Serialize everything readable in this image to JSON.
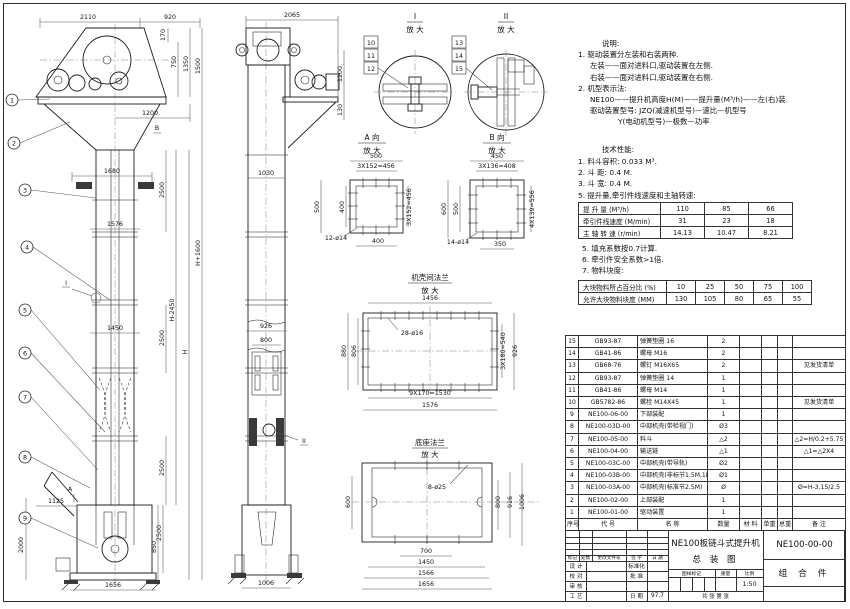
{
  "front": {
    "balloons": [
      "1",
      "2",
      "3",
      "4",
      "5",
      "6",
      "7",
      "8",
      "9"
    ],
    "marker_a": "A",
    "marker_b": "B",
    "marker_i": "I",
    "dims": {
      "t2110": "2110",
      "t920": "920",
      "r170": "170",
      "r750": "750",
      "r1350": "1350",
      "r1500": "1500",
      "w1200": "1200",
      "w1680": "1680",
      "seg2500": "2500",
      "w1576": "1576",
      "w1450": "1450",
      "hplus": "H+1600",
      "hminus": "H-2450",
      "h": "H",
      "w1125": "1125",
      "h2000": "2000",
      "h850": "850",
      "w1656": "1656"
    }
  },
  "side": {
    "marker_ii": "II",
    "dims": {
      "t2065": "2065",
      "r1200": "1200",
      "r130": "130",
      "w1030": "1030",
      "w926": "926",
      "w800": "800",
      "w1006": "1006"
    }
  },
  "details": {
    "d1": {
      "label": "I",
      "zoom": "放 大",
      "balloons": [
        "10",
        "11",
        "12"
      ]
    },
    "d2": {
      "label": "II",
      "zoom": "放 大",
      "balloons": [
        "13",
        "14",
        "15"
      ]
    },
    "va": {
      "label": "A 向",
      "zoom": "放 大",
      "dims": {
        "w500": "500",
        "p456": "3X152=456",
        "h500": "500",
        "h400": "400",
        "p456r": "3X152=456",
        "holes": "12-ø14",
        "b400": "400"
      }
    },
    "vb": {
      "label": "B 向",
      "zoom": "放 大",
      "dims": {
        "w450": "450",
        "p408": "3X136=408",
        "h600": "600",
        "h500": "500",
        "p556": "4X139=556",
        "holes": "14-ø14",
        "b350": "350"
      }
    },
    "fl": {
      "label": "机壳间法兰",
      "zoom": "放 大",
      "dims": {
        "w1456": "1456",
        "holes": "28-ø16",
        "h880": "880",
        "h806": "806",
        "p540": "3X180=540",
        "h926": "926",
        "p1530": "9X170=1530",
        "w1576": "1576"
      }
    },
    "bs": {
      "label": "底座法兰",
      "zoom": "放 大",
      "dims": {
        "holes": "8-ø25",
        "h600": "600",
        "h800": "800",
        "h916": "916",
        "h1006": "1006",
        "b700": "700",
        "b1450": "1450",
        "b1566": "1566",
        "b1656": "1656"
      }
    }
  },
  "notes": {
    "heading": "说明:",
    "lines": [
      "1. 驱动装置分左装和右装两种.",
      "左装——面对进料口,驱动装置在左侧.",
      "右装——面对进料口,驱动装置在右侧.",
      "2. 机型表示法:",
      "NE100——提升机高度H(M)——提升量(M³/h)——左(右)装.",
      "驱动装置型号: JZQ(减速机型号)—速比—机型号",
      "Y(电动机型号)—极数—功率"
    ]
  },
  "perf": {
    "heading": "技术性能:",
    "items_top": [
      "1. 料斗容积: 0.033 M³.",
      "2. 斗  距: 0.4 M.",
      "3. 斗  宽: 0.4 M."
    ],
    "item_table": "5. 提升量,牵引件线速度和主轴转速:",
    "table1": {
      "rows": [
        {
          "label": "提 升 量 (M³/h)",
          "v": [
            "110",
            "85",
            "66"
          ]
        },
        {
          "label": "牵引件线速度 (M/min)",
          "v": [
            "31",
            "23",
            "18"
          ]
        },
        {
          "label": "主 轴 转 速 (r/min)",
          "v": [
            "14.13",
            "10.47",
            "8.21"
          ]
        }
      ]
    },
    "items_mid": [
      "5. 填充系数按0.7计算.",
      "6. 牵引件安全系数>1倍.",
      "7. 物料块度:"
    ],
    "table2": {
      "rows": [
        {
          "label": "大块物料所占百分比 (%)",
          "v": [
            "10",
            "25",
            "50",
            "75",
            "100"
          ]
        },
        {
          "label": "允许大块物料块度 (MM)",
          "v": [
            "130",
            "105",
            "80",
            "65",
            "55"
          ]
        }
      ]
    }
  },
  "bom": {
    "header": [
      "序号",
      "代  号",
      "名  称",
      "数量",
      "材 料",
      "单重",
      "总重",
      "备  注"
    ],
    "rows": [
      {
        "no": "15",
        "code": "GB93-87",
        "name": "弹簧垫圈 16",
        "qty": "2",
        "remark": ""
      },
      {
        "no": "14",
        "code": "GB41-86",
        "name": "螺母 M16",
        "qty": "2",
        "remark": ""
      },
      {
        "no": "13",
        "code": "GB68-76",
        "name": "螺钉 M16X65",
        "qty": "2",
        "remark": "见发货清单"
      },
      {
        "no": "12",
        "code": "GB93-87",
        "name": "弹簧垫圈 14",
        "qty": "1",
        "remark": ""
      },
      {
        "no": "11",
        "code": "GB41-86",
        "name": "螺母 M14",
        "qty": "1",
        "remark": ""
      },
      {
        "no": "10",
        "code": "GB5782-86",
        "name": "螺栓 M14X45",
        "qty": "1",
        "remark": "见发货清单"
      },
      {
        "no": "9",
        "code": "NE100-06-00",
        "name": "下部装配",
        "qty": "1",
        "remark": ""
      },
      {
        "no": "8",
        "code": "NE100-03D-00",
        "name": "中部机壳(带检视门)",
        "qty": "Ø3",
        "remark": ""
      },
      {
        "no": "7",
        "code": "NE100-05-00",
        "name": "料斗",
        "qty": "△2",
        "remark": "△2=H/0.2+5.75"
      },
      {
        "no": "6",
        "code": "NE100-04-00",
        "name": "输送链",
        "qty": "△1",
        "remark": "△1=△2X4"
      },
      {
        "no": "5",
        "code": "NE100-03C-00",
        "name": "中部机壳(带导轨)",
        "qty": "Ø2",
        "remark": ""
      },
      {
        "no": "4",
        "code": "NE100-03B-00",
        "name": "中部机壳(非标节1.5M,1M)",
        "qty": "Ø1",
        "remark": ""
      },
      {
        "no": "3",
        "code": "NE100-03A-00",
        "name": "中部机壳(标准节2.5M)",
        "qty": "Ø",
        "remark": "Ø=H-3.15/2.5"
      },
      {
        "no": "2",
        "code": "NE100-02-00",
        "name": "上部装配",
        "qty": "1",
        "remark": ""
      },
      {
        "no": "1",
        "code": "NE100-01-00",
        "name": "驱动装置",
        "qty": "1",
        "remark": ""
      }
    ]
  },
  "titleblock": {
    "rev_header": [
      "标记",
      "处数",
      "更改文件号",
      "签 字",
      "日 期"
    ],
    "roles": [
      {
        "l": "设 计",
        "r": "标准化",
        "v": ""
      },
      {
        "l": "校 对",
        "r": "批 准",
        "v": ""
      },
      {
        "l": "审 核",
        "r": "",
        "v": ""
      },
      {
        "l": "工 艺",
        "r": "日 期",
        "v": "97.7"
      }
    ],
    "title_line1": "NE100板链斗式提升机",
    "title_line2": "总  装  图",
    "drawing_no": "NE100-00-00",
    "item_type": "组 合 件",
    "stamp_label": "图样标记",
    "weight_label": "重量",
    "scale_label": "比例",
    "scale_value": "1:50",
    "sheets_label": "共    张  第    张"
  }
}
